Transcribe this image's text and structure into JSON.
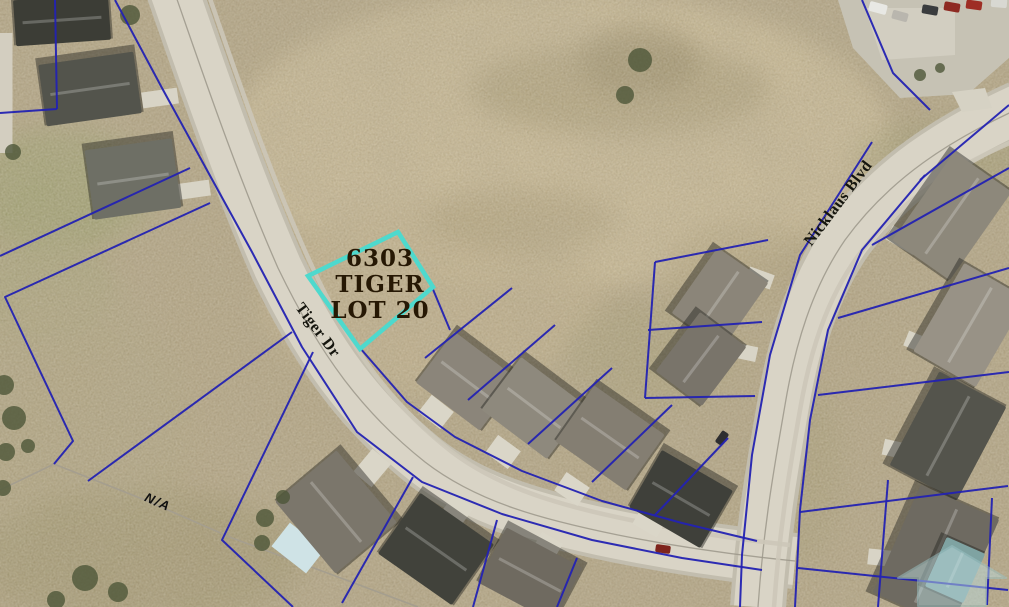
{
  "map": {
    "labels": {
      "lot": {
        "lines": [
          "6303",
          "TIGER",
          "LOT 20"
        ]
      },
      "streets": [
        {
          "id": "tiger-dr",
          "text": "Tiger Dr"
        },
        {
          "id": "nicklaus-blvd",
          "text": "Nicklaus Blvd"
        }
      ],
      "parcel_note": "N/A"
    },
    "colors": {
      "highlight_outline": "#4ED9CD",
      "lot_label_text": "#261804",
      "parcel_line": "#2322B2",
      "field": "#B3A585",
      "field_light": "#CBBC98",
      "road": "#D9D4C6",
      "road_casing": "#C2BDAE",
      "road_centerline": "#9B968A",
      "roof_gray": "#8B857A",
      "roof_dark": "#3F403A",
      "watermark_teal": "#B9D8DA"
    },
    "features": {
      "highlight_polygon": "398,232 433,287 360,349 308,276",
      "patches": [
        [
          560,
          140,
          330,
          150,
          "#CBBC98",
          0.9
        ],
        [
          430,
          300,
          170,
          95,
          "#C2B28E",
          0.8
        ],
        [
          620,
          90,
          150,
          45,
          "#A1946F",
          0.5
        ],
        [
          520,
          220,
          95,
          32,
          "#A89A74",
          0.45
        ],
        [
          750,
          270,
          85,
          48,
          "#B0A17C",
          0.5
        ],
        [
          640,
          60,
          60,
          35,
          "#8F825F",
          0.45
        ],
        [
          60,
          190,
          95,
          62,
          "#97A06B",
          0.55
        ],
        [
          40,
          290,
          75,
          52,
          "#A3A577",
          0.5
        ],
        [
          60,
          430,
          125,
          150,
          "#B0A682",
          0.6
        ],
        [
          140,
          560,
          165,
          70,
          "#9A9168",
          0.5
        ],
        [
          950,
          160,
          95,
          42,
          "#9D9A70",
          0.45
        ],
        [
          800,
          470,
          42,
          95,
          "#A59C74",
          0.4
        ],
        [
          650,
          355,
          85,
          52,
          "#A9A078",
          0.5
        ]
      ],
      "roads": [
        "M 172,-15 C 200,65 235,170 278,268 C 320,355 362,412 425,462 C 478,503 545,520 618,535 C 688,549 745,556 795,561",
        "M 1020,108 C 950,140 890,178 845,240 C 812,288 795,345 785,405 C 776,458 764,520 758,607"
      ],
      "parking": [
        {
          "points": "838,0 1009,0 1009,58 968,94 900,98 853,48",
          "fill": "#C6C2B4"
        },
        {
          "points": "865,8 955,8 955,55 882,60",
          "fill": "#D2CEC1"
        },
        {
          "points": "952,92 985,88 992,108 962,112",
          "fill": "#D6D2C4"
        }
      ],
      "gray_lines": [
        {
          "pts": [
            [
              0,
              490
            ],
            [
              54,
              464
            ],
            [
              145,
              500
            ],
            [
              232,
              538
            ],
            [
              330,
              574
            ],
            [
              418,
              607
            ]
          ],
          "w": 1.6,
          "c": "#A59E8E"
        }
      ],
      "sidewalks": [
        "M 207,-10 C 235,70 268,170 310,262 C 350,350 392,405 452,452 C 505,492 572,508 640,522 C 700,534 752,541 790,545",
        "M 1012,142 C 952,168 898,202 858,256 C 826,300 810,352 800,410 C 791,462 780,522 774,607"
      ],
      "pads": [
        [
          6,
          93,
          13,
          120,
          0,
          "#D3CEC0"
        ],
        [
          160,
          98,
          36,
          16,
          -8,
          "#D8D4C6"
        ],
        [
          192,
          190,
          36,
          16,
          -8,
          "#D8D4C6"
        ],
        [
          436,
          412,
          28,
          22,
          38,
          "#DAD6C8"
        ],
        [
          503,
          452,
          28,
          22,
          36,
          "#DAD6C8"
        ],
        [
          572,
          489,
          28,
          22,
          34,
          "#DAD6C8"
        ],
        [
          650,
          521,
          28,
          22,
          30,
          "#DAD6C8"
        ],
        [
          372,
          468,
          24,
          30,
          40,
          "#DAD6C8"
        ],
        [
          456,
          512,
          24,
          28,
          36,
          "#DAD6C8"
        ],
        [
          546,
          549,
          24,
          26,
          30,
          "#DAD6C8"
        ],
        [
          760,
          278,
          26,
          15,
          20,
          "#D8D4C6"
        ],
        [
          744,
          352,
          26,
          15,
          12,
          "#D8D4C6"
        ],
        [
          903,
          240,
          32,
          16,
          30,
          "#D8D4C6"
        ],
        [
          921,
          344,
          32,
          16,
          22,
          "#D8D4C6"
        ],
        [
          899,
          450,
          32,
          16,
          12,
          "#D8D4C6"
        ],
        [
          884,
          558,
          32,
          16,
          6,
          "#D8D4C6"
        ],
        [
          298,
          548,
          44,
          30,
          38,
          "#CFE3E6"
        ]
      ],
      "houses": [
        [
          62,
          20,
          95,
          46,
          -4,
          "#3C3D36"
        ],
        [
          90,
          89,
          96,
          62,
          -8,
          "#53544C"
        ],
        [
          133,
          179,
          88,
          70,
          -8,
          "#6E6F65"
        ],
        [
          336,
          512,
          94,
          80,
          50,
          "#7B766B"
        ],
        [
          436,
          549,
          90,
          74,
          35,
          "#41423B"
        ],
        [
          530,
          575,
          86,
          62,
          28,
          "#6F6A60"
        ],
        [
          467,
          381,
          80,
          64,
          37,
          "#8B857A"
        ],
        [
          534,
          408,
          82,
          66,
          37,
          "#8E897D"
        ],
        [
          610,
          438,
          86,
          68,
          35,
          "#847E72"
        ],
        [
          681,
          499,
          82,
          66,
          30,
          "#3F403A"
        ],
        [
          720,
          298,
          80,
          62,
          -55,
          "#8B8579"
        ],
        [
          701,
          359,
          74,
          58,
          -53,
          "#79746A"
        ],
        [
          952,
          216,
          108,
          70,
          -55,
          "#8D887B"
        ],
        [
          970,
          325,
          102,
          72,
          -60,
          "#989286"
        ],
        [
          948,
          436,
          106,
          76,
          -62,
          "#54544C"
        ],
        [
          936,
          556,
          118,
          86,
          -66,
          "#6E6A61"
        ],
        [
          955,
          570,
          54,
          42,
          -66,
          "#7FA3A2"
        ]
      ],
      "cars": [
        [
          878,
          8,
          18,
          10,
          15,
          "#E8E8E4"
        ],
        [
          900,
          16,
          16,
          9,
          15,
          "#B9B6AE"
        ],
        [
          930,
          10,
          16,
          9,
          10,
          "#3A3C3E"
        ],
        [
          952,
          7,
          16,
          9,
          10,
          "#8E2A22"
        ],
        [
          974,
          5,
          16,
          9,
          8,
          "#9E2E24"
        ],
        [
          999,
          3,
          16,
          9,
          5,
          "#D8D8D2"
        ],
        [
          663,
          549,
          15,
          8,
          8,
          "#7E241C"
        ],
        [
          722,
          438,
          14,
          8,
          -55,
          "#2E2E30"
        ]
      ],
      "trees": [
        [
          13,
          152,
          8
        ],
        [
          4,
          385,
          10
        ],
        [
          14,
          418,
          12
        ],
        [
          6,
          452,
          9
        ],
        [
          28,
          446,
          7
        ],
        [
          3,
          488,
          8
        ],
        [
          85,
          578,
          13
        ],
        [
          118,
          592,
          10
        ],
        [
          56,
          600,
          9
        ],
        [
          265,
          518,
          9
        ],
        [
          262,
          543,
          8
        ],
        [
          283,
          497,
          7
        ],
        [
          130,
          15,
          10
        ],
        [
          640,
          60,
          12
        ],
        [
          625,
          95,
          9
        ],
        [
          920,
          75,
          6
        ],
        [
          940,
          68,
          5
        ]
      ],
      "parcel_lines": [
        [
          [
            55,
            0
          ],
          [
            57,
            109
          ]
        ],
        [
          [
            0,
            113
          ],
          [
            57,
            109
          ]
        ],
        [
          [
            190,
            168
          ],
          [
            0,
            256
          ]
        ],
        [
          [
            210,
            203
          ],
          [
            5,
            297
          ],
          [
            73,
            441
          ],
          [
            54,
            464
          ]
        ],
        [
          [
            88,
            481
          ],
          [
            292,
            332
          ]
        ],
        [
          [
            313,
            352
          ],
          [
            222,
            540
          ],
          [
            293,
            607
          ]
        ],
        [
          [
            413,
            477
          ],
          [
            342,
            603
          ]
        ],
        [
          [
            497,
            520
          ],
          [
            473,
            607
          ]
        ],
        [
          [
            577,
            558
          ],
          [
            557,
            607
          ]
        ],
        [
          [
            115,
            0
          ],
          [
            162,
            88
          ],
          [
            208,
            172
          ],
          [
            252,
            252
          ],
          [
            302,
            347
          ],
          [
            357,
            432
          ],
          [
            422,
            482
          ],
          [
            502,
            514
          ],
          [
            592,
            540
          ],
          [
            682,
            558
          ],
          [
            762,
            570
          ]
        ],
        [
          [
            360,
            348
          ],
          [
            407,
            402
          ],
          [
            455,
            437
          ],
          [
            522,
            471
          ],
          [
            602,
            501
          ],
          [
            682,
            523
          ],
          [
            757,
            541
          ]
        ],
        [
          [
            425,
            358
          ],
          [
            512,
            288
          ]
        ],
        [
          [
            468,
            400
          ],
          [
            555,
            325
          ]
        ],
        [
          [
            528,
            444
          ],
          [
            612,
            368
          ]
        ],
        [
          [
            592,
            482
          ],
          [
            672,
            405
          ]
        ],
        [
          [
            655,
            515
          ],
          [
            728,
            438
          ]
        ],
        [
          [
            432,
            287
          ],
          [
            450,
            330
          ]
        ],
        [
          [
            655,
            262
          ],
          [
            768,
            240
          ]
        ],
        [
          [
            648,
            330
          ],
          [
            762,
            322
          ]
        ],
        [
          [
            645,
            398
          ],
          [
            755,
            396
          ]
        ],
        [
          [
            655,
            262
          ],
          [
            645,
            398
          ]
        ],
        [
          [
            872,
            142
          ],
          [
            800,
            255
          ],
          [
            770,
            355
          ],
          [
            752,
            455
          ],
          [
            742,
            555
          ],
          [
            740,
            607
          ]
        ],
        [
          [
            925,
            175
          ],
          [
            862,
            250
          ],
          [
            828,
            330
          ],
          [
            810,
            420
          ],
          [
            800,
            510
          ],
          [
            795,
            607
          ]
        ],
        [
          [
            920,
            180
          ],
          [
            1009,
            105
          ]
        ],
        [
          [
            872,
            245
          ],
          [
            1009,
            168
          ]
        ],
        [
          [
            838,
            318
          ],
          [
            1009,
            268
          ]
        ],
        [
          [
            818,
            395
          ],
          [
            1009,
            372
          ]
        ],
        [
          [
            800,
            512
          ],
          [
            1008,
            486
          ]
        ],
        [
          [
            798,
            568
          ],
          [
            1008,
            590
          ]
        ],
        [
          [
            888,
            480
          ],
          [
            878,
            607
          ]
        ],
        [
          [
            992,
            498
          ],
          [
            987,
            605
          ]
        ],
        [
          [
            862,
            0
          ],
          [
            893,
            73
          ],
          [
            930,
            110
          ]
        ]
      ]
    }
  }
}
